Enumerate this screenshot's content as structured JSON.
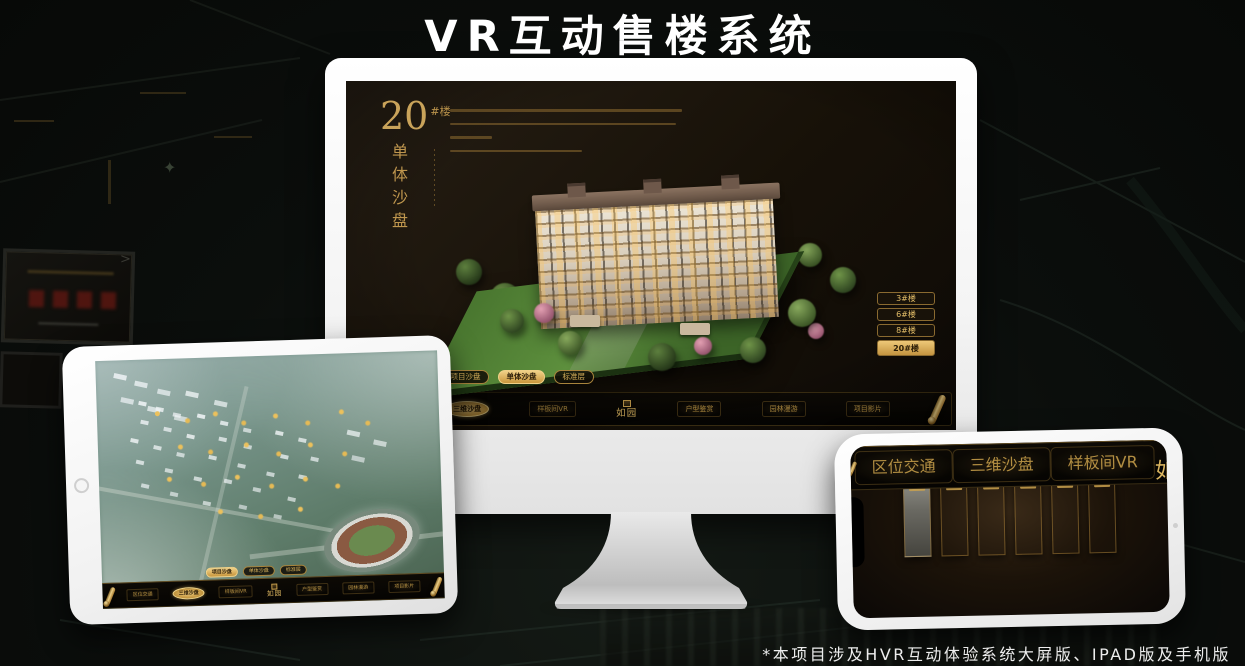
{
  "title": "VR互动售楼系统",
  "footnote": "*本项目涉及HVR互动体验系统大屏版、IPAD版及手机版",
  "colors": {
    "gold": "#c79a45",
    "gold_bright": "#eac87a",
    "screen_dark": "#171108",
    "device_white": "#f4f4f4"
  },
  "app": {
    "logo": "如园",
    "tabs": [
      {
        "label": "项目沙盘"
      },
      {
        "label": "单体沙盘"
      },
      {
        "label": "标准层"
      }
    ],
    "nav_items": [
      {
        "label": "区位交通"
      },
      {
        "label": "三维沙盘"
      },
      {
        "label": "样板间VR"
      },
      {
        "label": "户型鉴赏"
      },
      {
        "label": "园林漫游"
      },
      {
        "label": "项目影片"
      }
    ]
  },
  "desktop": {
    "heading_number": "20",
    "heading_unit": "#楼",
    "heading_vertical": "单体沙盘",
    "active_tab": "单体沙盘",
    "active_nav": "三维沙盘",
    "floor_buttons": [
      {
        "label": "3#楼"
      },
      {
        "label": "6#楼"
      },
      {
        "label": "8#楼"
      },
      {
        "label": "20#楼"
      }
    ]
  },
  "tablet": {
    "active_tab": "项目沙盘",
    "active_nav": "三维沙盘"
  },
  "phone": {
    "active_nav": "园林漫游",
    "gallery_panel_count": 6
  }
}
